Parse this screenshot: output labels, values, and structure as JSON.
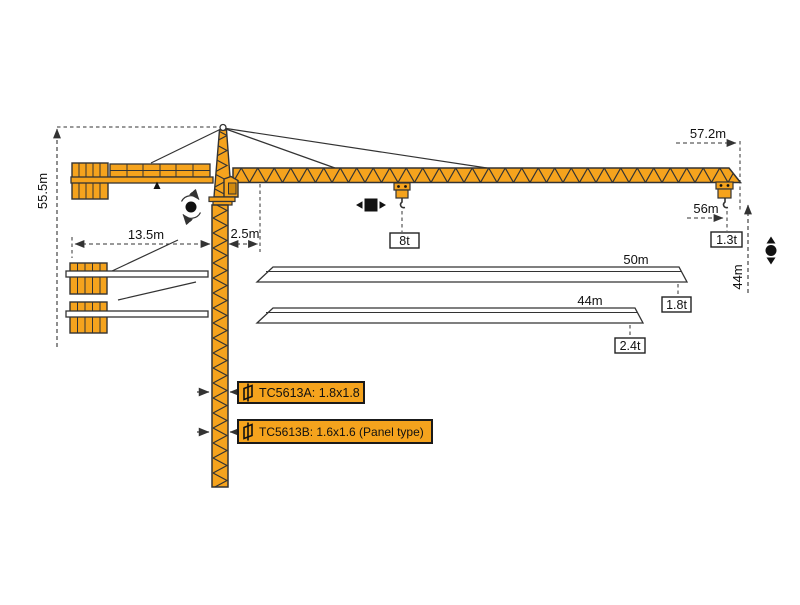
{
  "title": "TC5613 flat-top tower crane dimension diagram",
  "colors": {
    "crane": "#F5A31D",
    "outline": "#333333",
    "line": "#333333",
    "background": "#FFFFFF",
    "cab_window": "#D28A0F"
  },
  "labels": {
    "total_height": "55.5m",
    "counter_jib_radius": "13.5m",
    "jib_root_offset": "2.5m",
    "tip_radius": "57.2m",
    "max_hook_radius": "56m",
    "hook_height": "44m",
    "max_load": "8t",
    "tip_load": "1.3t"
  },
  "jib_variants": [
    {
      "length": "50m",
      "tip_load": "1.8t"
    },
    {
      "length": "44m",
      "tip_load": "2.4t"
    }
  ],
  "mast_variants": [
    {
      "label": "TC5613A:  1.8x1.8"
    },
    {
      "label": "TC5613B:  1.6x1.6  (Panel type)"
    }
  ],
  "icons": {
    "slewing": "rotate-arrows-around-dot",
    "trolley_travel": "black-square-with-left-right-arrows",
    "hoisting": "black-dot-with-up-down-arrows",
    "mast_section": "mast-cross-section-glyph"
  }
}
